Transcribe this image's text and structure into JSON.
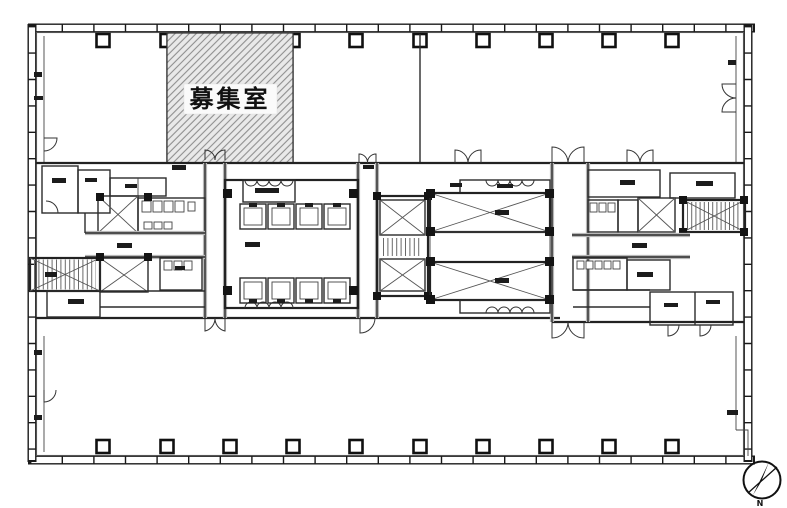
{
  "page": {
    "background_color": "#ffffff"
  },
  "floor_plan": {
    "vacant_room_label": "募集室",
    "compass_label": "N",
    "colors": {
      "linework": "#1a1a1a",
      "hatch_fill": "#e9e9e9",
      "hatch_line": "#8f8f8f",
      "gray_zone": "#d6d6d6",
      "label_bg": "#fafafa"
    },
    "features": {
      "top_column_count": 10,
      "bottom_column_count": 10,
      "elevator_car_count": 8,
      "stairwell_count": 3,
      "large_x_shaft_count": 2
    }
  }
}
